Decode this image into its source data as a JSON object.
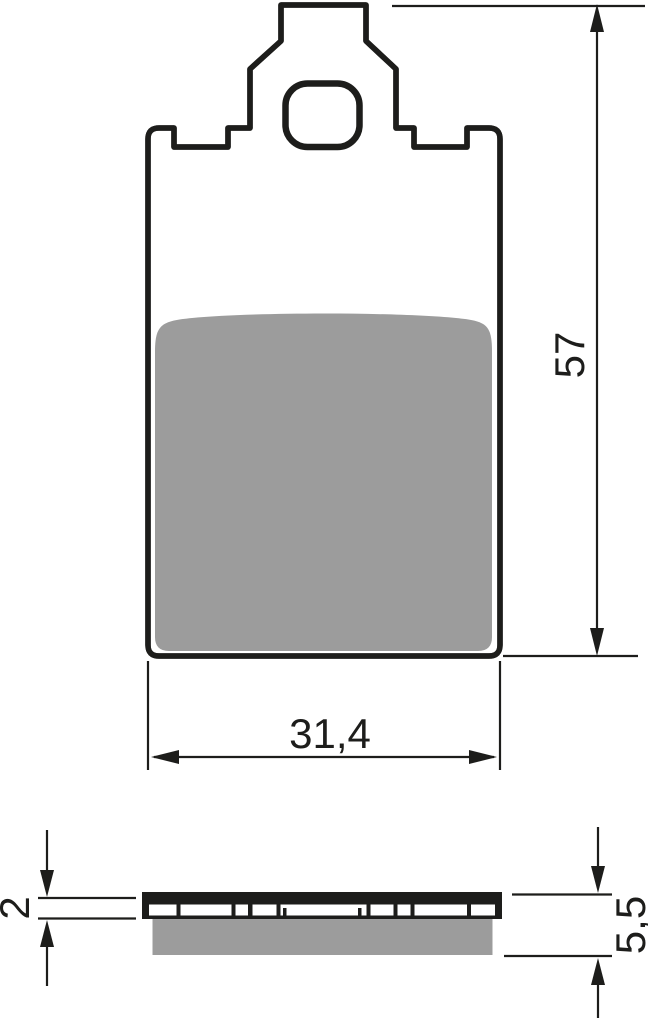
{
  "drawing": {
    "type": "technical-drawing-brake-pad",
    "front_view": {
      "height_label": "57",
      "width_label": "31,4"
    },
    "side_view": {
      "backplate_thickness_label": "2",
      "total_thickness_label": "5,5"
    }
  },
  "colors": {
    "line": "#1d1d1b",
    "friction_pad": "#9c9c9c",
    "background": "#ffffff"
  }
}
